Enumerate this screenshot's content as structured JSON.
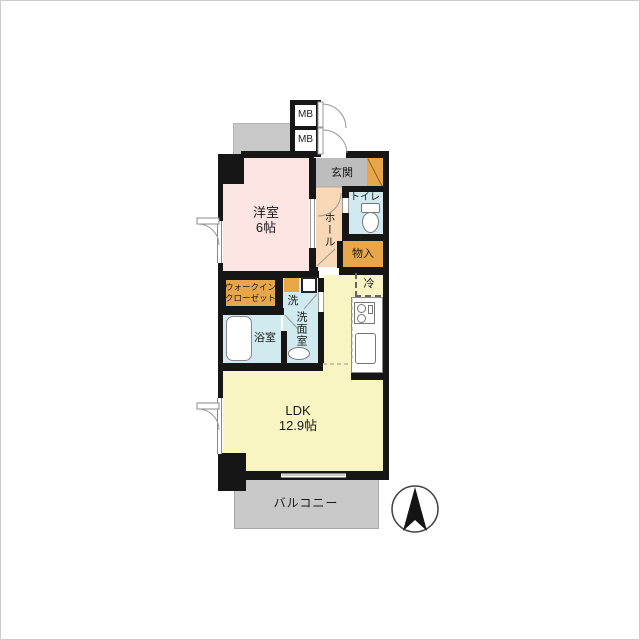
{
  "plan_title": "1LDK apartment floor plan",
  "rooms": {
    "western_room": {
      "label": "洋室",
      "size": "6帖"
    },
    "ldk": {
      "label": "LDK",
      "size": "12.9帖"
    },
    "entrance": {
      "label": "玄関"
    },
    "hall": {
      "label": "ホール"
    },
    "toilet": {
      "label": "トイレ"
    },
    "storage": {
      "label": "物入"
    },
    "walk_in_closet": {
      "label_line1": "ウォークイン",
      "label_line2": "クローゼット"
    },
    "washroom": {
      "label": "洗面室",
      "washer_label": "洗"
    },
    "bathroom": {
      "label": "浴室"
    },
    "refrigerator": {
      "label": "冷"
    },
    "balcony": {
      "label": "バルコニー"
    },
    "meter_box_top": {
      "label": "MB"
    },
    "meter_box_bottom": {
      "label": "MB"
    }
  },
  "colors": {
    "wall": "#161616",
    "western_room_fill": "#fbe4e2",
    "hall_fill": "#f8d8b6",
    "orange_fill": "#e8a64b",
    "wet_area_fill": "#d0eaf0",
    "ldk_fill": "#f8f5c2",
    "entrance_floor_fill": "#bdbdbe",
    "balcony_fill": "#c8c8c8",
    "door_arc_stroke": "#999999"
  },
  "icons": {
    "compass": "north-arrow",
    "toilet": "toilet-bowl-and-tank",
    "bathtub": "bathtub",
    "washer": "washing-machine-pan",
    "vanity_sink": "oval-sink",
    "stove": "two-burner-stove",
    "kitchen_sink": "kitchen-sink",
    "fridge": "refrigerator-dashed-outline"
  }
}
